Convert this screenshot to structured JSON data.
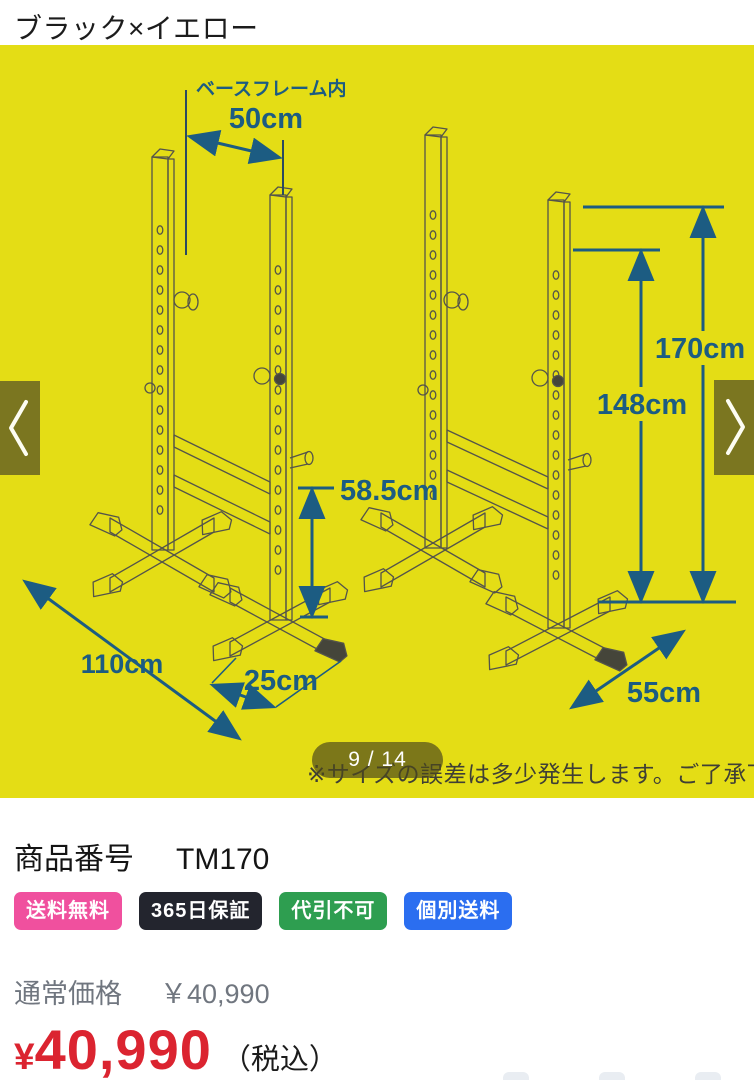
{
  "page": {
    "variant_title": "ブラック×イエロー"
  },
  "carousel": {
    "counter": "9 / 14",
    "note": "※サイズの誤差は多少発生します。ご了承下さい。",
    "prev_icon": "chevron-left",
    "next_icon": "chevron-right",
    "background_color": "#e4dd15"
  },
  "diagram": {
    "dimension_color": "#1c5c82",
    "labels": {
      "base_frame": "ベースフレーム内",
      "base_frame_width": "50cm",
      "total_height": "170cm",
      "rack_height": "148cm",
      "safety_height": "58.5cm",
      "base_depth": "110cm",
      "foot_length": "25cm",
      "base_width": "55cm"
    }
  },
  "product": {
    "number_label": "商品番号",
    "number_value": "TM170",
    "badges": [
      {
        "label": "送料無料",
        "color": "#f0509e"
      },
      {
        "label": "365日保証",
        "color": "#23252e"
      },
      {
        "label": "代引不可",
        "color": "#2e9e50"
      },
      {
        "label": "個別送料",
        "color": "#2b6ef0"
      }
    ],
    "regular_price_label": "通常価格",
    "regular_price_amount": "￥40,990",
    "sale_price_currency": "¥",
    "sale_price_amount": "40,990",
    "tax_label": "（税込）",
    "sale_price_color": "#db2430"
  }
}
